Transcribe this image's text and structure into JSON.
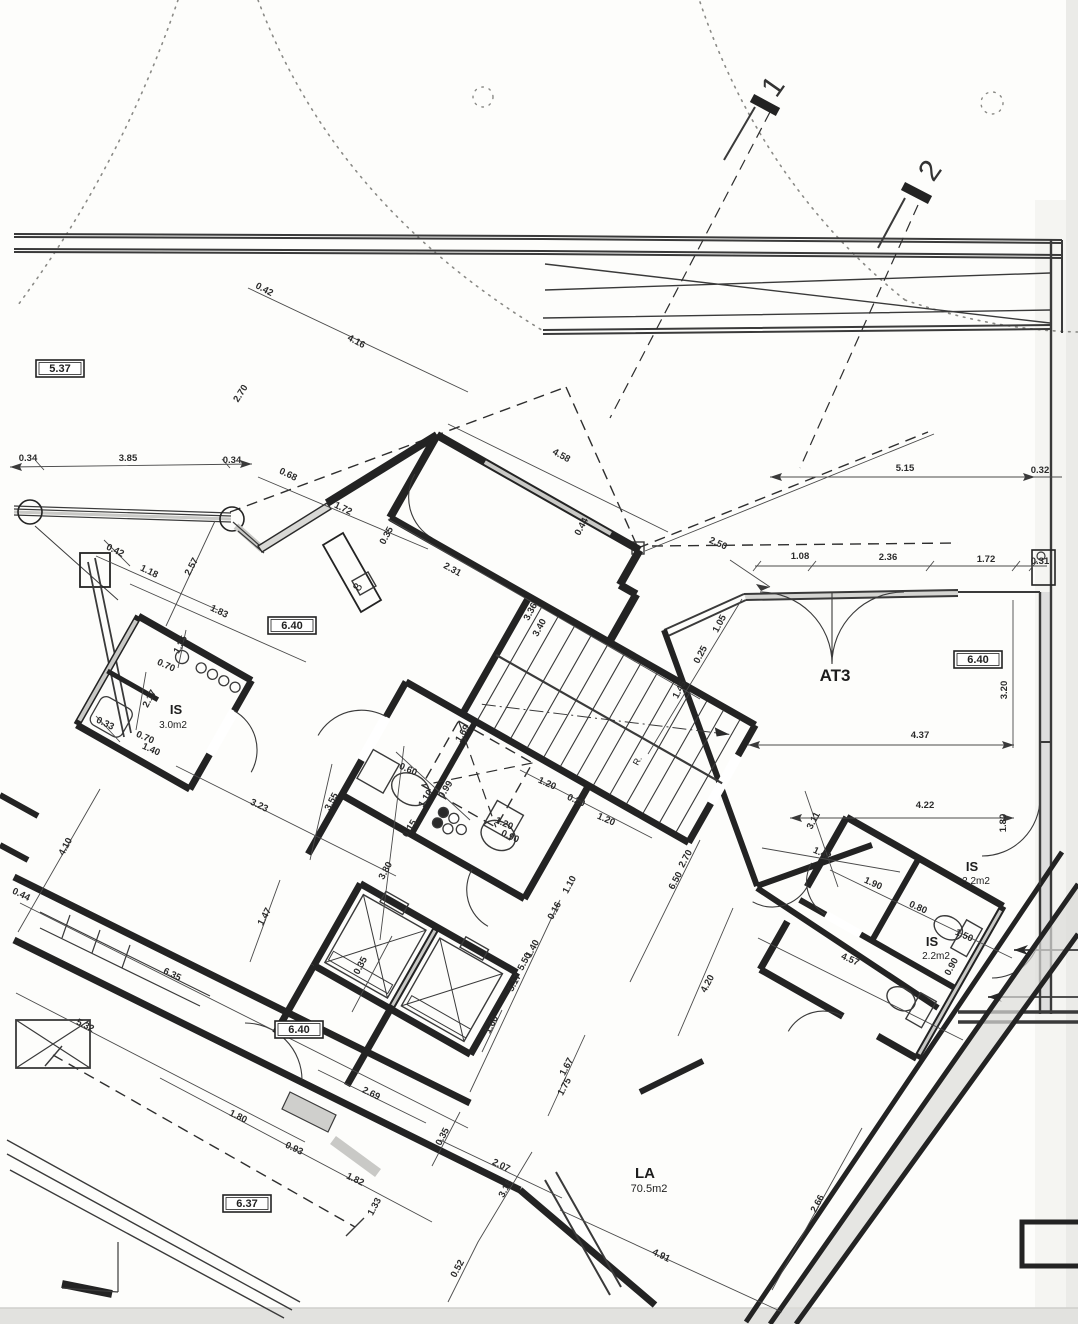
{
  "drawing": {
    "ink_color": "#232323",
    "hatch_color": "#c9c9c6",
    "paper_color": "#fdfdfb",
    "room_labels": [
      {
        "text": "AT3",
        "x": 835,
        "y": 681,
        "rot": 0,
        "size": 17,
        "bold": true
      },
      {
        "text": "LA",
        "x": 645,
        "y": 1178,
        "rot": 0,
        "size": 15,
        "bold": true
      },
      {
        "text": "70.5m2",
        "x": 649,
        "y": 1192,
        "rot": 0,
        "size": 11,
        "bold": false
      },
      {
        "text": "IS",
        "x": 176,
        "y": 714,
        "rot": 0,
        "size": 13,
        "bold": true
      },
      {
        "text": "3.0m2",
        "x": 173,
        "y": 728,
        "rot": 0,
        "size": 10,
        "bold": false
      },
      {
        "text": "IS",
        "x": 972,
        "y": 871,
        "rot": 0,
        "size": 13,
        "bold": true
      },
      {
        "text": "2.2m2",
        "x": 976,
        "y": 884,
        "rot": 0,
        "size": 10,
        "bold": false
      },
      {
        "text": "IS",
        "x": 932,
        "y": 946,
        "rot": 0,
        "size": 13,
        "bold": true
      },
      {
        "text": "2.2m2",
        "x": 936,
        "y": 959,
        "rot": 0,
        "size": 10,
        "bold": false
      },
      {
        "text": "8",
        "x": 361,
        "y": 589,
        "rot": -60,
        "size": 12,
        "bold": false
      },
      {
        "text": "R.",
        "x": 640,
        "y": 762,
        "rot": -62,
        "size": 9,
        "bold": false
      }
    ],
    "level_labels": [
      {
        "text": "5.37",
        "x": 60,
        "y": 372
      },
      {
        "text": "6.40",
        "x": 292,
        "y": 629
      },
      {
        "text": "6.40",
        "x": 978,
        "y": 663
      },
      {
        "text": "6.40",
        "x": 299,
        "y": 1033
      },
      {
        "text": "6.37",
        "x": 247,
        "y": 1207
      }
    ],
    "section_labels": [
      {
        "text": "1",
        "x": 781,
        "y": 92,
        "rot": -55
      },
      {
        "text": "2",
        "x": 938,
        "y": 176,
        "rot": -55
      }
    ],
    "dim_labels": [
      {
        "text": "0.42",
        "x": 263,
        "y": 292,
        "rot": 28
      },
      {
        "text": "4.16",
        "x": 355,
        "y": 344,
        "rot": 28
      },
      {
        "text": "2.70",
        "x": 243,
        "y": 395,
        "rot": -57
      },
      {
        "text": "0.34",
        "x": 28,
        "y": 461,
        "rot": 0
      },
      {
        "text": "3.85",
        "x": 128,
        "y": 461,
        "rot": 0
      },
      {
        "text": "0.34",
        "x": 232,
        "y": 463,
        "rot": 0
      },
      {
        "text": "0.68",
        "x": 287,
        "y": 477,
        "rot": 26
      },
      {
        "text": "1.72",
        "x": 342,
        "y": 511,
        "rot": 26
      },
      {
        "text": "0.35",
        "x": 389,
        "y": 537,
        "rot": -62
      },
      {
        "text": "4.58",
        "x": 560,
        "y": 458,
        "rot": 29
      },
      {
        "text": "0.44",
        "x": 584,
        "y": 528,
        "rot": -62
      },
      {
        "text": "2.50",
        "x": 717,
        "y": 546,
        "rot": 24
      },
      {
        "text": "2.31",
        "x": 451,
        "y": 572,
        "rot": 29
      },
      {
        "text": "3.36",
        "x": 533,
        "y": 613,
        "rot": -62
      },
      {
        "text": "3.40",
        "x": 542,
        "y": 629,
        "rot": -62
      },
      {
        "text": "1.05",
        "x": 722,
        "y": 625,
        "rot": -62
      },
      {
        "text": "0.25",
        "x": 703,
        "y": 656,
        "rot": -62
      },
      {
        "text": "1.45",
        "x": 682,
        "y": 691,
        "rot": -62
      },
      {
        "text": "5.15",
        "x": 905,
        "y": 471,
        "rot": 0
      },
      {
        "text": "0.32",
        "x": 1040,
        "y": 473,
        "rot": 0
      },
      {
        "text": "1.08",
        "x": 800,
        "y": 559,
        "rot": 0
      },
      {
        "text": "2.36",
        "x": 888,
        "y": 560,
        "rot": 0
      },
      {
        "text": "1.72",
        "x": 986,
        "y": 562,
        "rot": 0
      },
      {
        "text": "0.31",
        "x": 1040,
        "y": 564,
        "rot": 0
      },
      {
        "text": "3.20",
        "x": 1007,
        "y": 690,
        "rot": -90
      },
      {
        "text": "4.37",
        "x": 920,
        "y": 738,
        "rot": 0
      },
      {
        "text": "4.22",
        "x": 925,
        "y": 808,
        "rot": 0
      },
      {
        "text": "3.11",
        "x": 816,
        "y": 822,
        "rot": -62
      },
      {
        "text": "1.42",
        "x": 821,
        "y": 856,
        "rot": 24
      },
      {
        "text": "1.80",
        "x": 1006,
        "y": 823,
        "rot": -90
      },
      {
        "text": "1.90",
        "x": 872,
        "y": 886,
        "rot": 24
      },
      {
        "text": "0.80",
        "x": 917,
        "y": 910,
        "rot": 24
      },
      {
        "text": "1.50",
        "x": 963,
        "y": 938,
        "rot": 24
      },
      {
        "text": "0.90",
        "x": 954,
        "y": 968,
        "rot": -62
      },
      {
        "text": "4.57",
        "x": 849,
        "y": 962,
        "rot": 24
      },
      {
        "text": "0.60",
        "x": 407,
        "y": 772,
        "rot": 24
      },
      {
        "text": "1.10",
        "x": 428,
        "y": 800,
        "rot": -58
      },
      {
        "text": "0.99",
        "x": 448,
        "y": 791,
        "rot": -58
      },
      {
        "text": "0.15",
        "x": 412,
        "y": 830,
        "rot": -58
      },
      {
        "text": "3.80",
        "x": 388,
        "y": 872,
        "rot": -62
      },
      {
        "text": "3.55",
        "x": 334,
        "y": 803,
        "rot": -62
      },
      {
        "text": "3.23",
        "x": 258,
        "y": 808,
        "rot": 26
      },
      {
        "text": "1.20",
        "x": 503,
        "y": 826,
        "rot": 24
      },
      {
        "text": "0.90",
        "x": 509,
        "y": 839,
        "rot": 24
      },
      {
        "text": "4.10",
        "x": 68,
        "y": 848,
        "rot": -62
      },
      {
        "text": "0.44",
        "x": 20,
        "y": 897,
        "rot": 26
      },
      {
        "text": "6.35",
        "x": 171,
        "y": 977,
        "rot": 26
      },
      {
        "text": "1.47",
        "x": 267,
        "y": 918,
        "rot": -62
      },
      {
        "text": "1.20",
        "x": 546,
        "y": 786,
        "rot": 24
      },
      {
        "text": "0.20",
        "x": 575,
        "y": 803,
        "rot": 24
      },
      {
        "text": "1.20",
        "x": 605,
        "y": 822,
        "rot": 24
      },
      {
        "text": "1.10",
        "x": 572,
        "y": 886,
        "rot": -62
      },
      {
        "text": "0.16",
        "x": 557,
        "y": 912,
        "rot": -62
      },
      {
        "text": "6.50",
        "x": 678,
        "y": 882,
        "rot": -62
      },
      {
        "text": "2.70",
        "x": 688,
        "y": 860,
        "rot": -62
      },
      {
        "text": "4.20",
        "x": 710,
        "y": 985,
        "rot": -62
      },
      {
        "text": "1.69",
        "x": 465,
        "y": 735,
        "rot": -58
      },
      {
        "text": "0.35",
        "x": 363,
        "y": 967,
        "rot": -62
      },
      {
        "text": "1.40",
        "x": 535,
        "y": 950,
        "rot": -62
      },
      {
        "text": "5.50",
        "x": 527,
        "y": 963,
        "rot": -62
      },
      {
        "text": "5.17",
        "x": 517,
        "y": 984,
        "rot": -62
      },
      {
        "text": "1.66",
        "x": 494,
        "y": 1026,
        "rot": -62
      },
      {
        "text": "0.35",
        "x": 445,
        "y": 1138,
        "rot": -62
      },
      {
        "text": "2.07",
        "x": 500,
        "y": 1168,
        "rot": 26
      },
      {
        "text": "3.16",
        "x": 508,
        "y": 1190,
        "rot": -62
      },
      {
        "text": "0.52",
        "x": 460,
        "y": 1270,
        "rot": -62
      },
      {
        "text": "4.91",
        "x": 660,
        "y": 1258,
        "rot": 26
      },
      {
        "text": "1.67",
        "x": 569,
        "y": 1068,
        "rot": -62
      },
      {
        "text": "1.75",
        "x": 567,
        "y": 1088,
        "rot": -62
      },
      {
        "text": "2.69",
        "x": 370,
        "y": 1096,
        "rot": 26
      },
      {
        "text": "5.32",
        "x": 84,
        "y": 1028,
        "rot": 26
      },
      {
        "text": "1.80",
        "x": 237,
        "y": 1119,
        "rot": 26
      },
      {
        "text": "0.93",
        "x": 293,
        "y": 1151,
        "rot": 26
      },
      {
        "text": "1.82",
        "x": 354,
        "y": 1182,
        "rot": 26
      },
      {
        "text": "1.33",
        "x": 377,
        "y": 1208,
        "rot": -62
      },
      {
        "text": "2.66",
        "x": 820,
        "y": 1205,
        "rot": -62
      },
      {
        "text": "2.17",
        "x": 152,
        "y": 700,
        "rot": -62
      },
      {
        "text": "0.70",
        "x": 165,
        "y": 668,
        "rot": 24
      },
      {
        "text": "0.70",
        "x": 144,
        "y": 740,
        "rot": 24
      },
      {
        "text": "1.40",
        "x": 150,
        "y": 752,
        "rot": 24
      },
      {
        "text": "1.35",
        "x": 183,
        "y": 646,
        "rot": -62
      },
      {
        "text": "0.33",
        "x": 104,
        "y": 726,
        "rot": 26
      },
      {
        "text": "1.18",
        "x": 148,
        "y": 574,
        "rot": 26
      },
      {
        "text": "2.57",
        "x": 194,
        "y": 568,
        "rot": -62
      },
      {
        "text": "0.42",
        "x": 114,
        "y": 553,
        "rot": 26
      },
      {
        "text": "1.83",
        "x": 218,
        "y": 614,
        "rot": 26
      }
    ]
  }
}
